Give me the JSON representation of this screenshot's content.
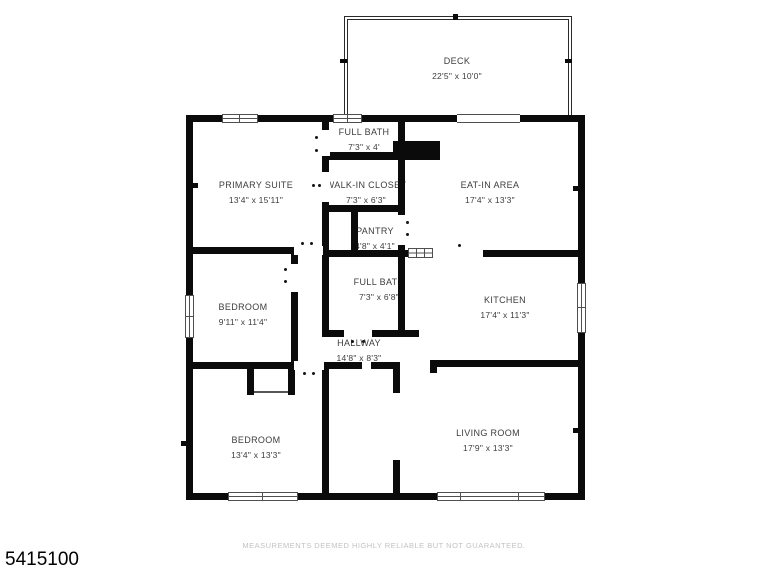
{
  "floorplan": {
    "wall_color": "#0b0b0b",
    "label_color": "#3d3d3d",
    "rooms": [
      {
        "id": "deck",
        "name": "DECK",
        "dims": "22'5\" x 10'0\""
      },
      {
        "id": "full-bath-top",
        "name": "FULL BATH",
        "dims": "7'3\" x 4'"
      },
      {
        "id": "primary-suite",
        "name": "PRIMARY SUITE",
        "dims": "13'4\" x 15'11\""
      },
      {
        "id": "walk-in-closet",
        "name": "WALK-IN CLOSET",
        "dims": "7'3\" x 6'3\""
      },
      {
        "id": "eat-in-area",
        "name": "EAT-IN AREA",
        "dims": "17'4\" x 13'3\""
      },
      {
        "id": "pantry",
        "name": "PANTRY",
        "dims": "4'8\" x 4'1\""
      },
      {
        "id": "bedroom-middle",
        "name": "BEDROOM",
        "dims": "9'11\" x 11'4\""
      },
      {
        "id": "full-bath-middle",
        "name": "FULL BATH",
        "dims": "7'3\" x 6'8\""
      },
      {
        "id": "kitchen",
        "name": "KITCHEN",
        "dims": "17'4\" x 11'3\""
      },
      {
        "id": "hallway",
        "name": "HALLWAY",
        "dims": "14'8\" x 8'3\""
      },
      {
        "id": "bedroom-bottom",
        "name": "BEDROOM",
        "dims": "13'4\" x 13'3\""
      },
      {
        "id": "living-room",
        "name": "LIVING ROOM",
        "dims": "17'9\" x 13'3\""
      }
    ]
  },
  "footer": {
    "disclaimer": "MEASUREMENTS DEEMED HIGHLY RELIABLE BUT NOT GUARANTEED.",
    "listing_id": "5415100"
  }
}
